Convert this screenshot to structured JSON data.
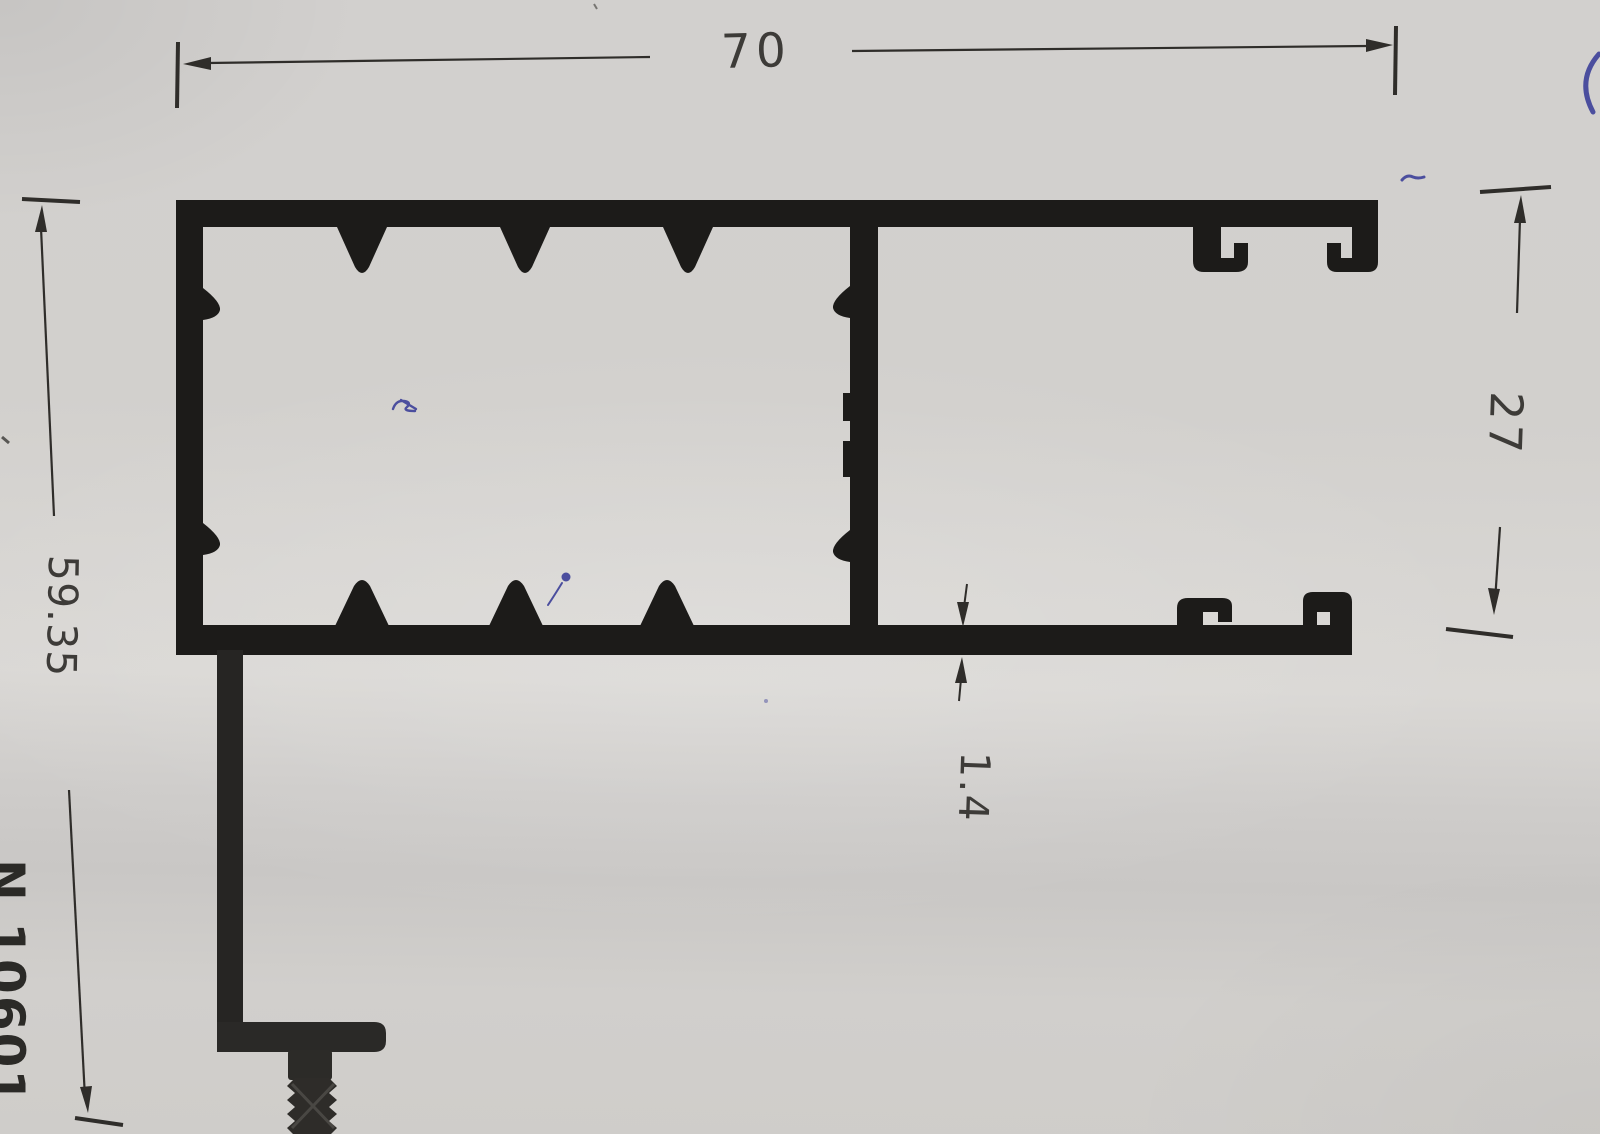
{
  "drawing": {
    "part_number": "N 10601",
    "dimensions": {
      "overall_width_mm": "70",
      "frame_height_mm": "27",
      "overall_height_mm": "59.35",
      "wall_thickness_mm": "1.4"
    }
  },
  "colors": {
    "paper": "#d2d0ce",
    "profile_ink": "#1c1b19",
    "dimension_ink": "#2f2d2a",
    "label_ink": "#3d3b38",
    "pen_blue": "#4b4e9e"
  }
}
